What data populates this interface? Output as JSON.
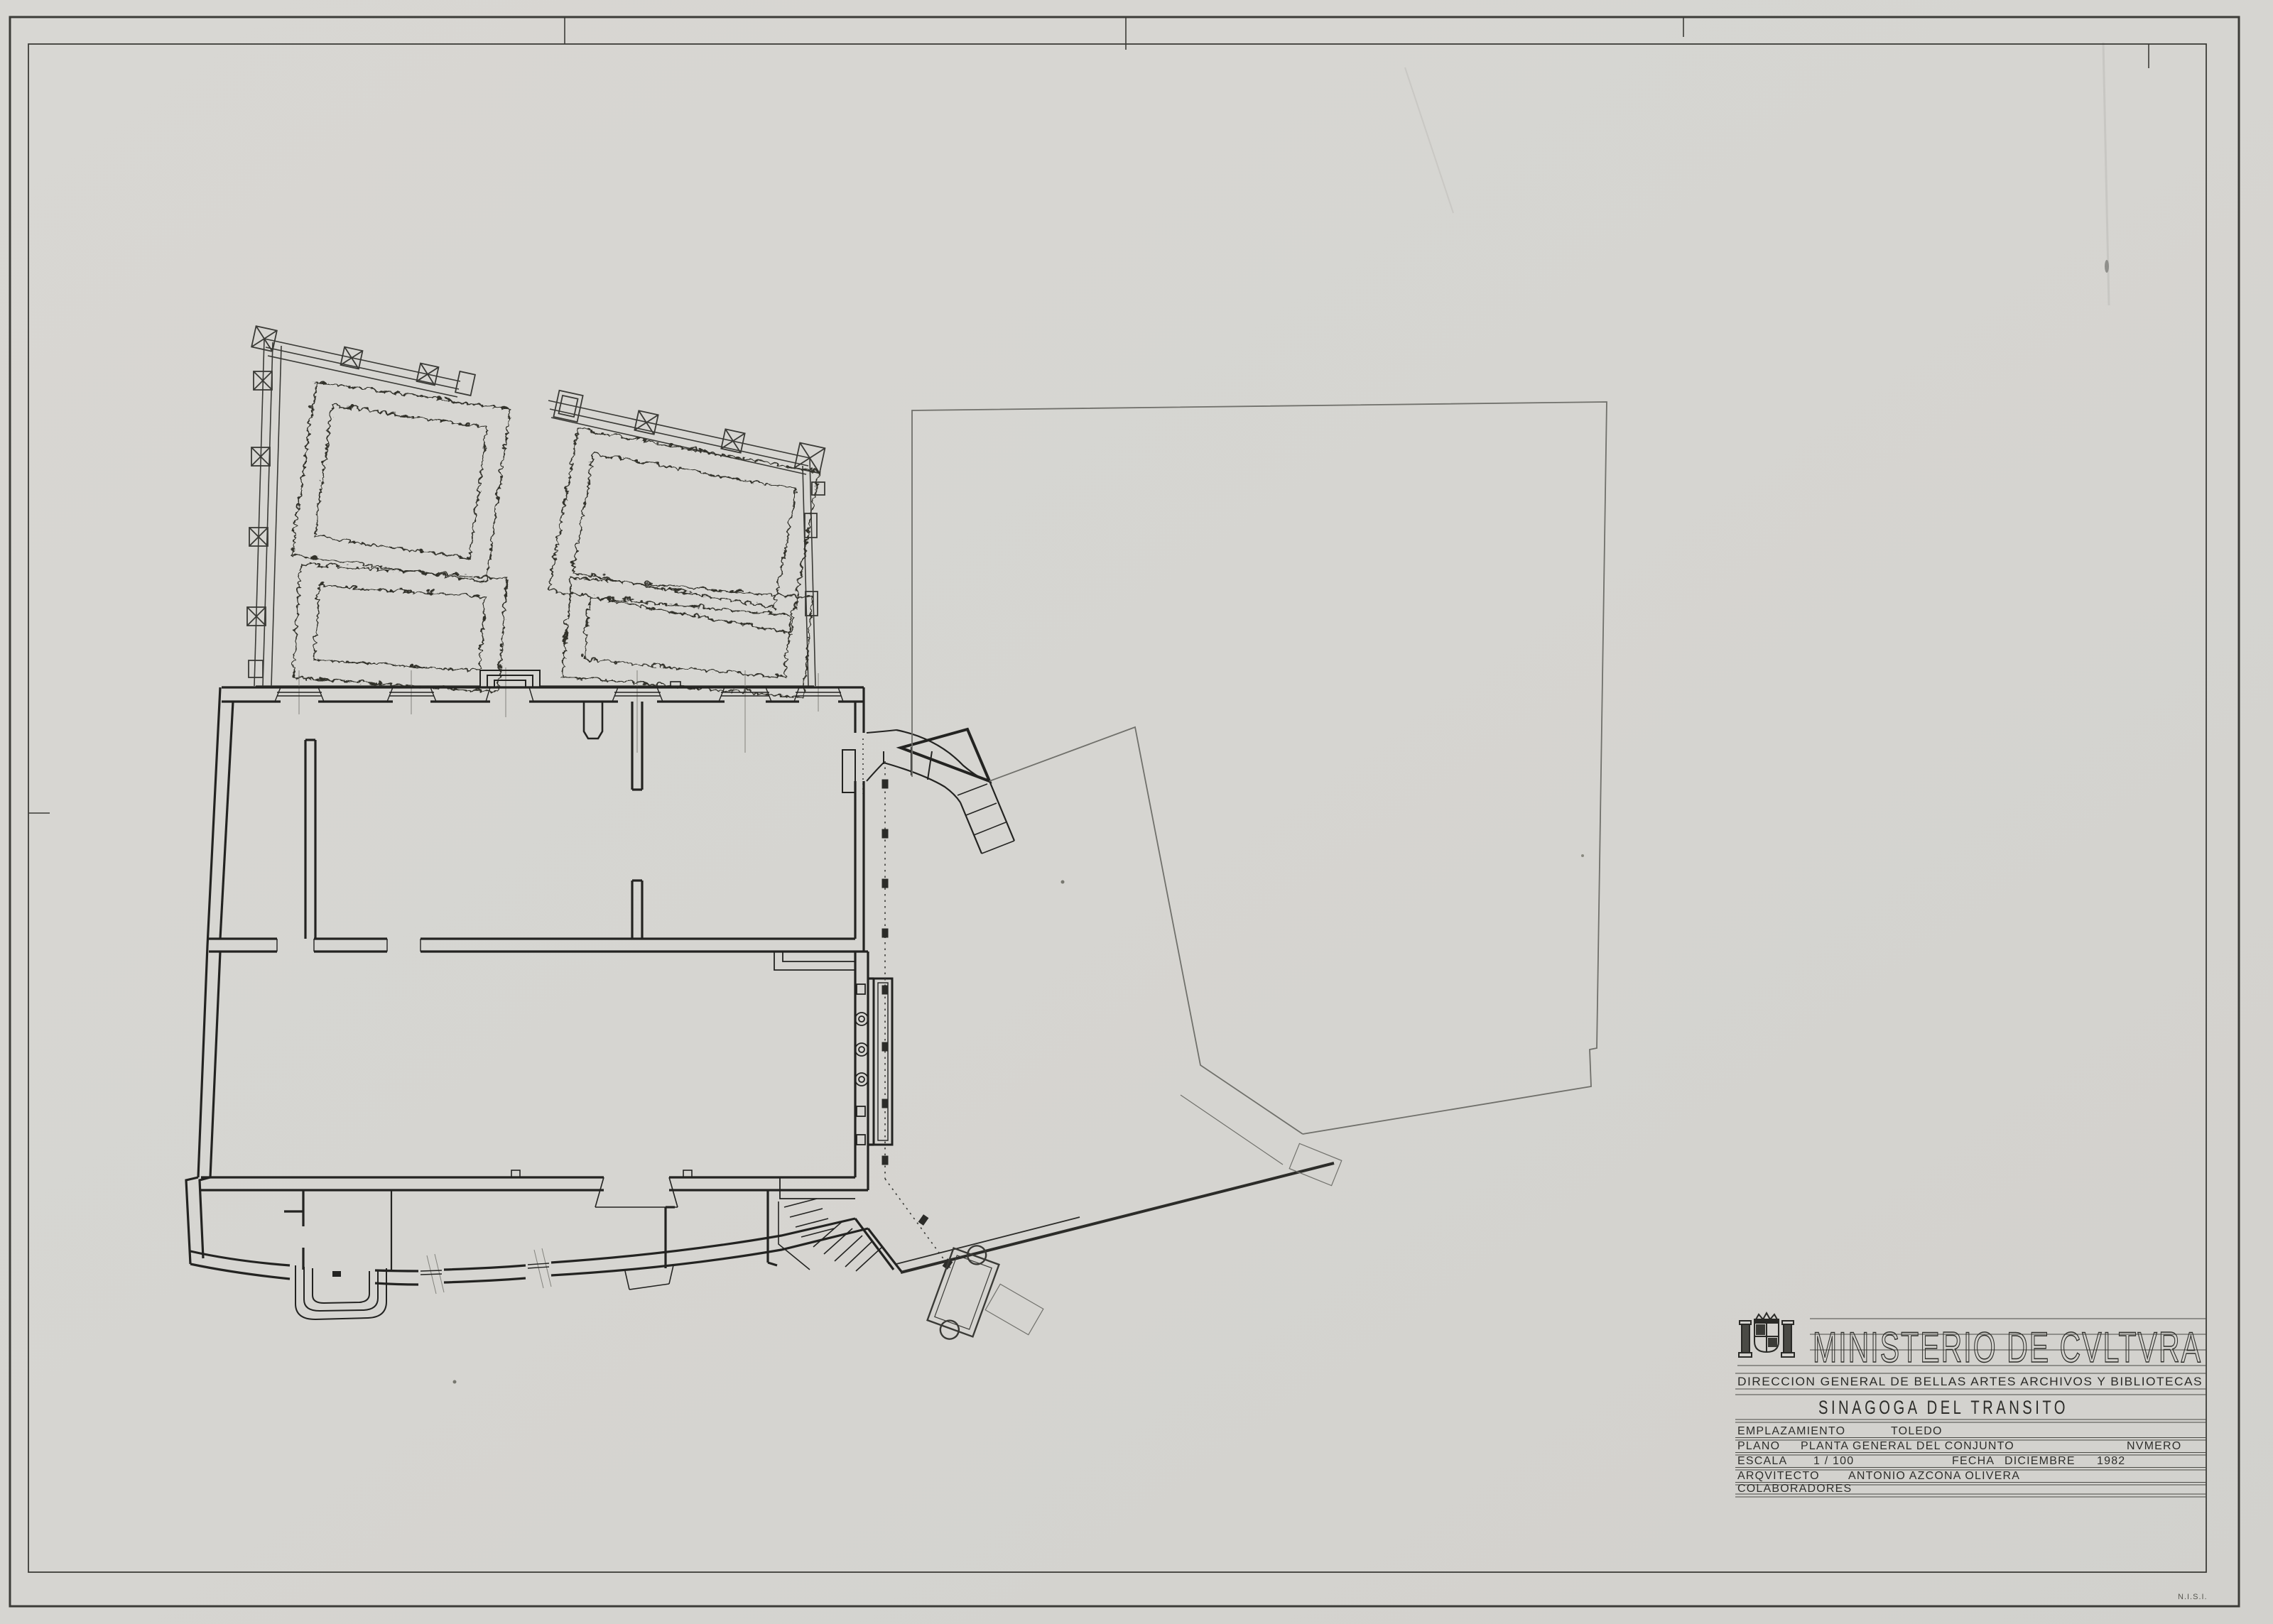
{
  "page": {
    "paper_color": "#d6d5d1",
    "ink_color": "#262624",
    "faint_color": "#8f8f8b",
    "frame_color": "#3c3c38",
    "footer_code": "N.I.S.I."
  },
  "title_block": {
    "ministry": "MINISTERIO DE CVLTVRA",
    "department": "DIRECCION GENERAL DE BELLAS ARTES ARCHIVOS Y BIBLIOTECAS",
    "project_title": "SINAGOGA DEL TRANSITO",
    "coat_of_arms_icon": "spain-coat-of-arms",
    "fields": {
      "emplazamiento_label": "EMPLAZAMIENTO",
      "emplazamiento_value": "TOLEDO",
      "plano_label": "PLANO",
      "plano_value": "PLANTA GENERAL DEL CONJUNTO",
      "numero_label": "NVMERO",
      "escala_label": "ESCALA",
      "escala_value": "1 / 100",
      "fecha_label": "FECHA",
      "fecha_value": "DICIEMBRE",
      "fecha_year": "1982",
      "arquitecto_label": "ARQVITECTO",
      "arquitecto_value": "ANTONIO AZCONA OLIVERA",
      "colaboradores_label": "COLABORADORES"
    }
  },
  "plan": {
    "drawing_type": "floor-plan",
    "garden_beds": 4
  }
}
